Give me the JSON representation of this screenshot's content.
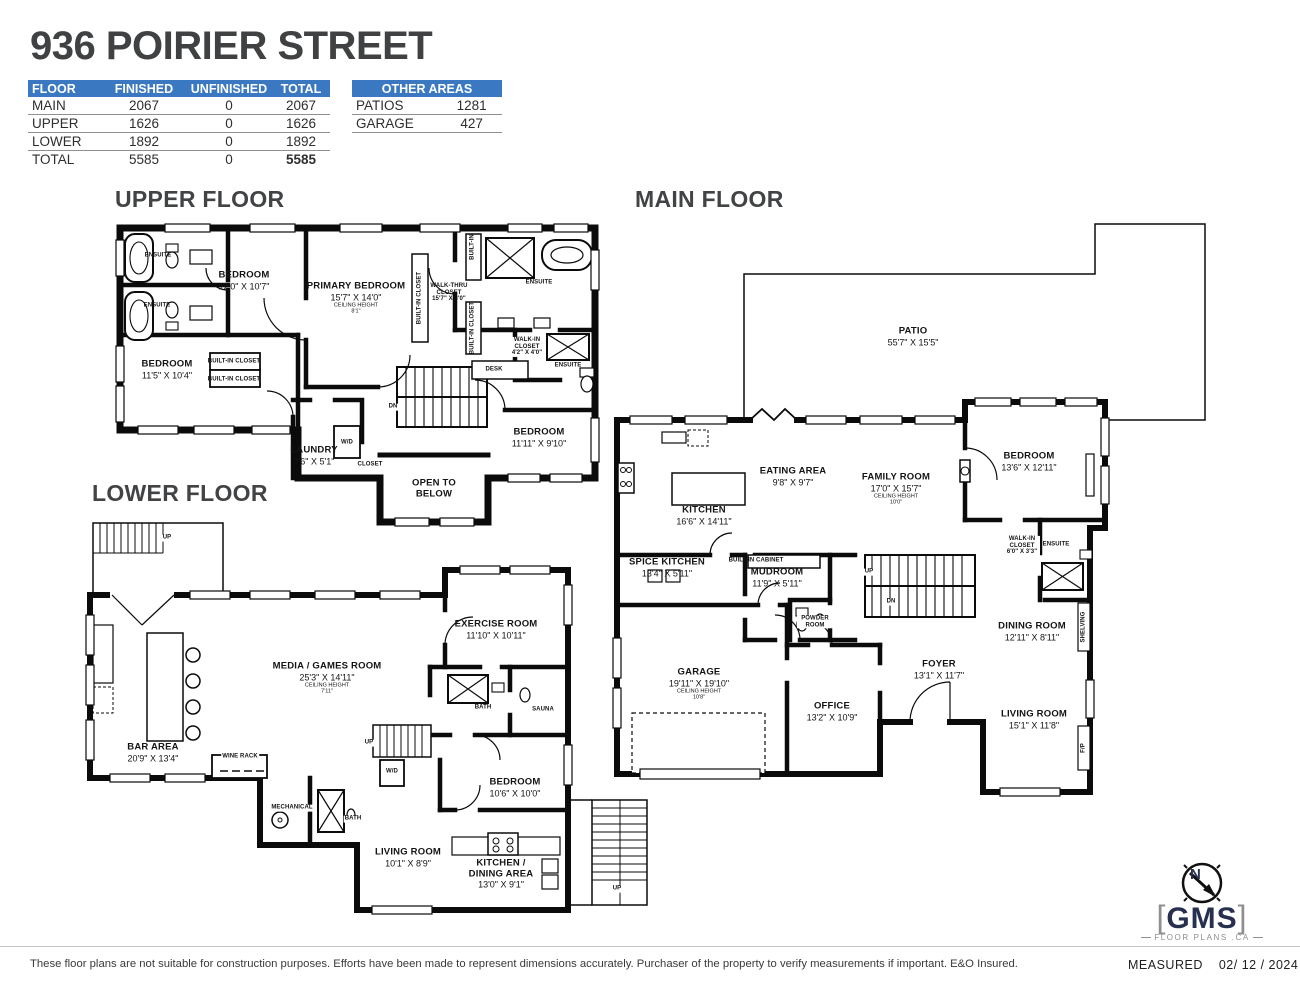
{
  "page": {
    "title": "936 POIRIER STREET"
  },
  "colors": {
    "table_header_blue": "#3a79c1",
    "wall_black": "#0b0b0b",
    "title_gray": "#3f4142",
    "logo_navy": "#27304e"
  },
  "summary_table": {
    "headers": [
      "FLOOR",
      "FINISHED",
      "UNFINISHED",
      "TOTAL"
    ],
    "rows": [
      [
        "MAIN",
        "2067",
        "0",
        "2067"
      ],
      [
        "UPPER",
        "1626",
        "0",
        "1626"
      ],
      [
        "LOWER",
        "1892",
        "0",
        "1892"
      ]
    ],
    "total": [
      "TOTAL",
      "5585",
      "0",
      "5585"
    ]
  },
  "other_areas": {
    "title": "OTHER AREAS",
    "rows": [
      [
        "PATIOS",
        "1281"
      ],
      [
        "GARAGE",
        "427"
      ]
    ]
  },
  "floors": {
    "upper": {
      "title": "UPPER FLOOR",
      "labels": [
        {
          "name": "ENSUITE"
        },
        {
          "name": "ENSUITE"
        },
        {
          "name": "BEDROOM",
          "dims": "12'0\" X 10'7\""
        },
        {
          "name": "PRIMARY BEDROOM",
          "dims": "15'7\" X 14'0\"",
          "sub": "CEILING HEIGHT",
          "sub2": "8'1\""
        },
        {
          "name": "WALK-THRU CLOSET",
          "dims": "15'7\" X 8'0\""
        },
        {
          "name": "BUILT-IN"
        },
        {
          "name": "BUILT-IN CLOSET"
        },
        {
          "name": "BUILT-IN CLOSET"
        },
        {
          "name": "ENSUITE"
        },
        {
          "name": "WALK-IN CLOSET",
          "dims": "4'2\" X 4'0\""
        },
        {
          "name": "ENSUITE"
        },
        {
          "name": "DESK"
        },
        {
          "name": "BEDROOM",
          "dims": "11'5\" X 10'4\""
        },
        {
          "name": "BUILT-IN CLOSET"
        },
        {
          "name": "BUILT-IN CLOSET"
        },
        {
          "name": "LAUNDRY",
          "dims": "7'6\" X 5'1\""
        },
        {
          "name": "W/D"
        },
        {
          "name": "CLOSET"
        },
        {
          "name": "OPEN TO BELOW"
        },
        {
          "name": "BEDROOM",
          "dims": "11'11\" X 9'10\""
        },
        {
          "name": "DN"
        }
      ]
    },
    "main": {
      "title": "MAIN FLOOR",
      "labels": [
        {
          "name": "PATIO",
          "dims": "55'7\" X 15'5\""
        },
        {
          "name": "EATING AREA",
          "dims": "9'8\" X 9'7\""
        },
        {
          "name": "KITCHEN",
          "dims": "16'6\" X 14'11\""
        },
        {
          "name": "FAMILY ROOM",
          "dims": "17'0\" X 15'7\"",
          "sub": "CEILING HEIGHT",
          "sub2": "10'0\""
        },
        {
          "name": "BEDROOM",
          "dims": "13'6\" X 12'11\""
        },
        {
          "name": "SPICE KITCHEN",
          "dims": "13'4\" X 5'11\""
        },
        {
          "name": "BUILT-IN CABINET"
        },
        {
          "name": "MUDROOM",
          "dims": "11'9\" X 5'11\""
        },
        {
          "name": "WALK-IN CLOSET",
          "dims": "6'0\" X 3'3\""
        },
        {
          "name": "ENSUITE"
        },
        {
          "name": "UP"
        },
        {
          "name": "DN"
        },
        {
          "name": "POWDER ROOM"
        },
        {
          "name": "GARAGE",
          "dims": "19'11\" X 19'10\"",
          "sub": "CEILING HEIGHT",
          "sub2": "10'8\""
        },
        {
          "name": "OFFICE",
          "dims": "13'2\" X 10'9\""
        },
        {
          "name": "FOYER",
          "dims": "13'1\" X 11'7\""
        },
        {
          "name": "DINING ROOM",
          "dims": "12'11\" X 8'11\""
        },
        {
          "name": "LIVING ROOM",
          "dims": "15'1\" X 11'8\""
        },
        {
          "name": "SHELVING"
        },
        {
          "name": "F/P"
        }
      ]
    },
    "lower": {
      "title": "LOWER FLOOR",
      "labels": [
        {
          "name": "UP"
        },
        {
          "name": "MEDIA / GAMES ROOM",
          "dims": "25'3\" X 14'11\"",
          "sub": "CEILING HEIGHT",
          "sub2": "7'11\""
        },
        {
          "name": "EXERCISE ROOM",
          "dims": "11'10\" X 10'11\""
        },
        {
          "name": "BAR AREA",
          "dims": "20'9\" X 13'4\""
        },
        {
          "name": "WINE RACK"
        },
        {
          "name": "BATH"
        },
        {
          "name": "SAUNA"
        },
        {
          "name": "UP"
        },
        {
          "name": "W/D"
        },
        {
          "name": "MECHANICAL"
        },
        {
          "name": "BATH"
        },
        {
          "name": "BEDROOM",
          "dims": "10'6\" X 10'0\""
        },
        {
          "name": "LIVING ROOM",
          "dims": "10'1\" X 8'9\""
        },
        {
          "name": "KITCHEN / DINING AREA",
          "dims": "13'0\" X 9'1\""
        },
        {
          "name": "UP"
        }
      ]
    }
  },
  "logo": {
    "bracket_left": "[",
    "brand": "GMS",
    "bracket_right": "]",
    "tagline": "FLOOR PLANS .CA",
    "compass_letter": "N"
  },
  "footer": {
    "disclaimer": "These floor plans are not suitable for construction purposes. Efforts have been made to represent dimensions accurately.  Purchaser of the property to verify measurements if important.  E&O Insured.",
    "measured_label": "MEASURED",
    "measured_date": "02/ 12 / 2024"
  }
}
